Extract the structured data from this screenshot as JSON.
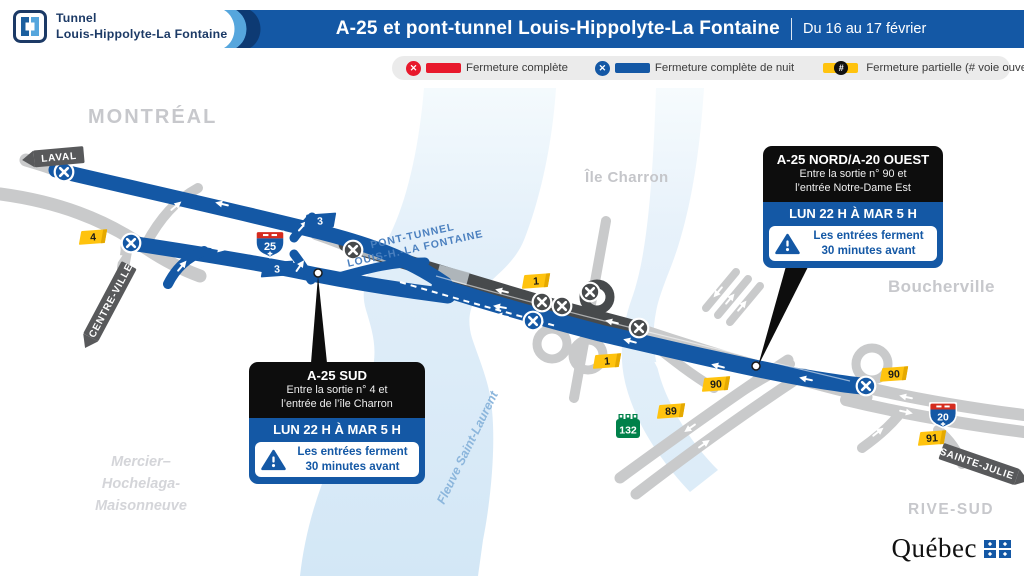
{
  "header": {
    "logo": {
      "line1": "Tunnel",
      "line2": "Louis-Hippolyte-La Fontaine"
    },
    "title": "A-25 et pont-tunnel Louis-Hippolyte-La Fontaine",
    "date_range": "Du 16 au 17 février"
  },
  "legend": {
    "items": [
      {
        "label": "Fermeture complète",
        "color": "#e8192c"
      },
      {
        "label": "Fermeture complète de nuit",
        "color": "#1458a5"
      },
      {
        "label": "Fermeture partielle (# voie ouverte)",
        "color": "#ffc30e",
        "symbol": "#"
      }
    ]
  },
  "map": {
    "area_labels": {
      "montreal": "MONTRÉAL",
      "ile_charron": "Île Charron",
      "boucherville": "Boucherville",
      "rive_sud": "RIVE-SUD",
      "borough_line1": "Mercier–",
      "borough_line2": "Hochelaga-",
      "borough_line3": "Maisonneuve",
      "river": "Fleuve Saint-Laurent",
      "tunnel_line1": "PONT-TUNNEL",
      "tunnel_line2": "LOUIS-H.-LA FONTAINE"
    },
    "direction_signs": {
      "laval": "LAVAL",
      "centre_ville": "CENTRE-VILLE",
      "sainte_julie": "SAINTE-JULIE"
    },
    "shields": {
      "a25": "25",
      "a20": "20",
      "r132": "132"
    },
    "exit_tabs": [
      {
        "label": "4",
        "x": 93,
        "y": 237,
        "style": "yellow"
      },
      {
        "label": "3",
        "x": 320,
        "y": 221,
        "style": "blue"
      },
      {
        "label": "3",
        "x": 277,
        "y": 269,
        "style": "blue"
      },
      {
        "label": "1",
        "x": 536,
        "y": 281,
        "style": "yellow"
      },
      {
        "label": "1",
        "x": 607,
        "y": 361,
        "style": "yellow"
      },
      {
        "label": "90",
        "x": 716,
        "y": 384,
        "style": "yellow"
      },
      {
        "label": "89",
        "x": 671,
        "y": 411,
        "style": "yellow"
      },
      {
        "label": "90",
        "x": 894,
        "y": 374,
        "style": "yellow"
      },
      {
        "label": "91",
        "x": 932,
        "y": 438,
        "style": "yellow"
      }
    ],
    "closure_markers": [
      {
        "x": 64,
        "y": 172,
        "type": "night"
      },
      {
        "x": 131,
        "y": 243,
        "type": "night"
      },
      {
        "x": 533,
        "y": 321,
        "type": "night"
      },
      {
        "x": 866,
        "y": 386,
        "type": "night"
      },
      {
        "x": 353,
        "y": 250,
        "type": "closed"
      },
      {
        "x": 542,
        "y": 302,
        "type": "closed"
      },
      {
        "x": 562,
        "y": 306,
        "type": "closed"
      },
      {
        "x": 590,
        "y": 292,
        "type": "closed"
      },
      {
        "x": 639,
        "y": 328,
        "type": "closed"
      }
    ],
    "arrows": [
      {
        "x": 222,
        "y": 204,
        "a": 193
      },
      {
        "x": 218,
        "y": 249,
        "a": 11
      },
      {
        "x": 182,
        "y": 266,
        "a": -50
      },
      {
        "x": 303,
        "y": 226,
        "a": -48
      },
      {
        "x": 300,
        "y": 266,
        "a": -55
      },
      {
        "x": 119,
        "y": 255,
        "a": 97
      },
      {
        "x": 176,
        "y": 206,
        "a": -40
      },
      {
        "x": 502,
        "y": 291,
        "a": 193
      },
      {
        "x": 612,
        "y": 322,
        "a": 193
      },
      {
        "x": 500,
        "y": 307,
        "a": 190
      },
      {
        "x": 502,
        "y": 316,
        "a": 190
      },
      {
        "x": 630,
        "y": 341,
        "a": 195
      },
      {
        "x": 718,
        "y": 366,
        "a": 194
      },
      {
        "x": 806,
        "y": 379,
        "a": 192
      },
      {
        "x": 660,
        "y": 366,
        "a": 216
      },
      {
        "x": 676,
        "y": 384,
        "a": 36
      },
      {
        "x": 690,
        "y": 428,
        "a": 145
      },
      {
        "x": 704,
        "y": 444,
        "a": -35
      },
      {
        "x": 718,
        "y": 292,
        "a": 130
      },
      {
        "x": 730,
        "y": 299,
        "a": -50
      },
      {
        "x": 742,
        "y": 306,
        "a": -50
      },
      {
        "x": 878,
        "y": 432,
        "a": -38
      },
      {
        "x": 952,
        "y": 449,
        "a": 35
      },
      {
        "x": 906,
        "y": 397,
        "a": 192
      },
      {
        "x": 906,
        "y": 412,
        "a": 12
      }
    ]
  },
  "callouts": {
    "left": {
      "title": "A-25 SUD",
      "line1": "Entre la sortie n° 4 et",
      "line2": "l’entrée de l’île Charron",
      "schedule": "LUN 22 H À MAR 5 H",
      "warn1": "Les entrées ferment",
      "warn2": "30 minutes avant"
    },
    "right": {
      "title": "A-25 NORD/A-20 OUEST",
      "line1": "Entre la sortie n° 90 et",
      "line2": "l’entrée Notre-Dame Est",
      "schedule": "LUN 22 H À MAR 5 H",
      "warn1": "Les entrées ferment",
      "warn2": "30 minutes avant"
    }
  },
  "footer": {
    "wordmark": "Québec"
  }
}
